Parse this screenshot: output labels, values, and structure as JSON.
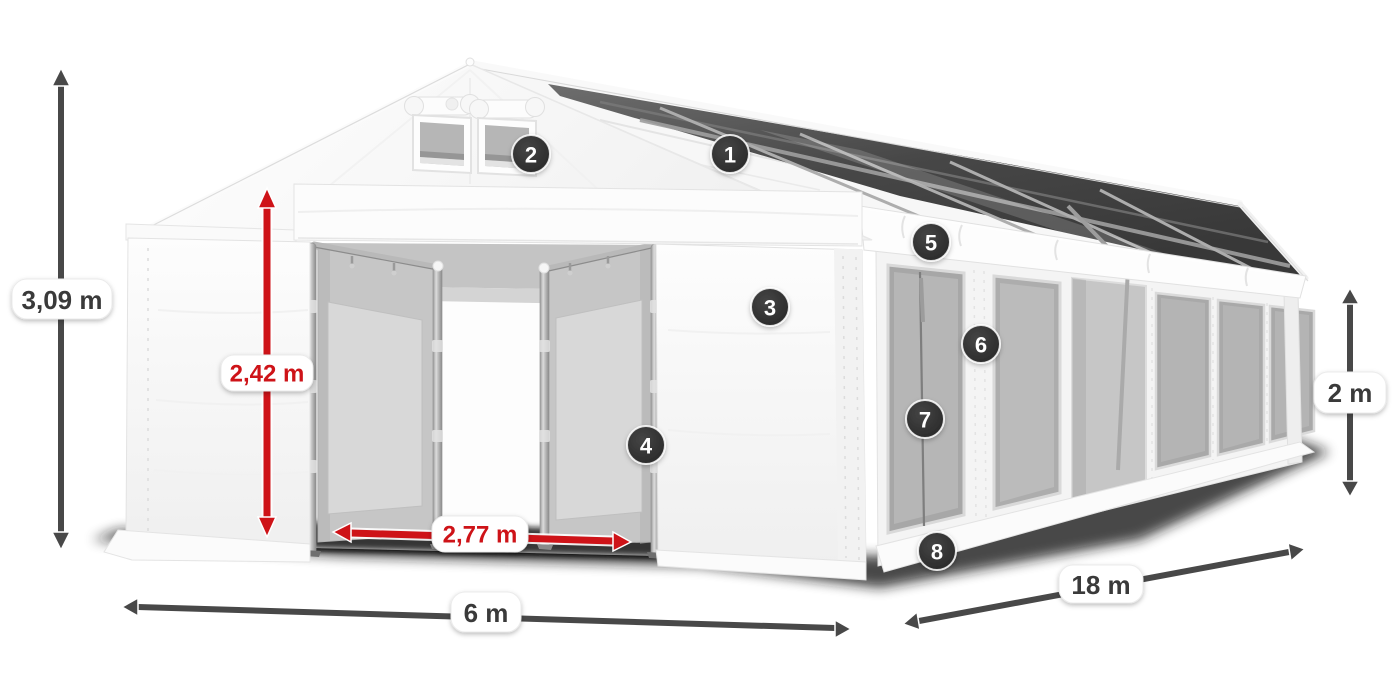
{
  "dimensions": {
    "total_height": {
      "label": "3,09 m",
      "style": "dark"
    },
    "door_height": {
      "label": "2,42 m",
      "style": "red"
    },
    "door_width": {
      "label": "2,77 m",
      "style": "red"
    },
    "front_width": {
      "label": "6 m",
      "style": "dark"
    },
    "side_length": {
      "label": "18 m",
      "style": "dark"
    },
    "side_wall_height": {
      "label": "2 m",
      "style": "dark"
    }
  },
  "callouts": [
    {
      "number": "1"
    },
    {
      "number": "2"
    },
    {
      "number": "3"
    },
    {
      "number": "4"
    },
    {
      "number": "5"
    },
    {
      "number": "6"
    },
    {
      "number": "7"
    },
    {
      "number": "8"
    }
  ],
  "colors": {
    "dimension_red": "#ce1318",
    "dimension_gray": "#484848",
    "badge_background": "#333333",
    "badge_text": "#ffffff",
    "label_text": "#3a3a3a",
    "background": "#ffffff"
  }
}
